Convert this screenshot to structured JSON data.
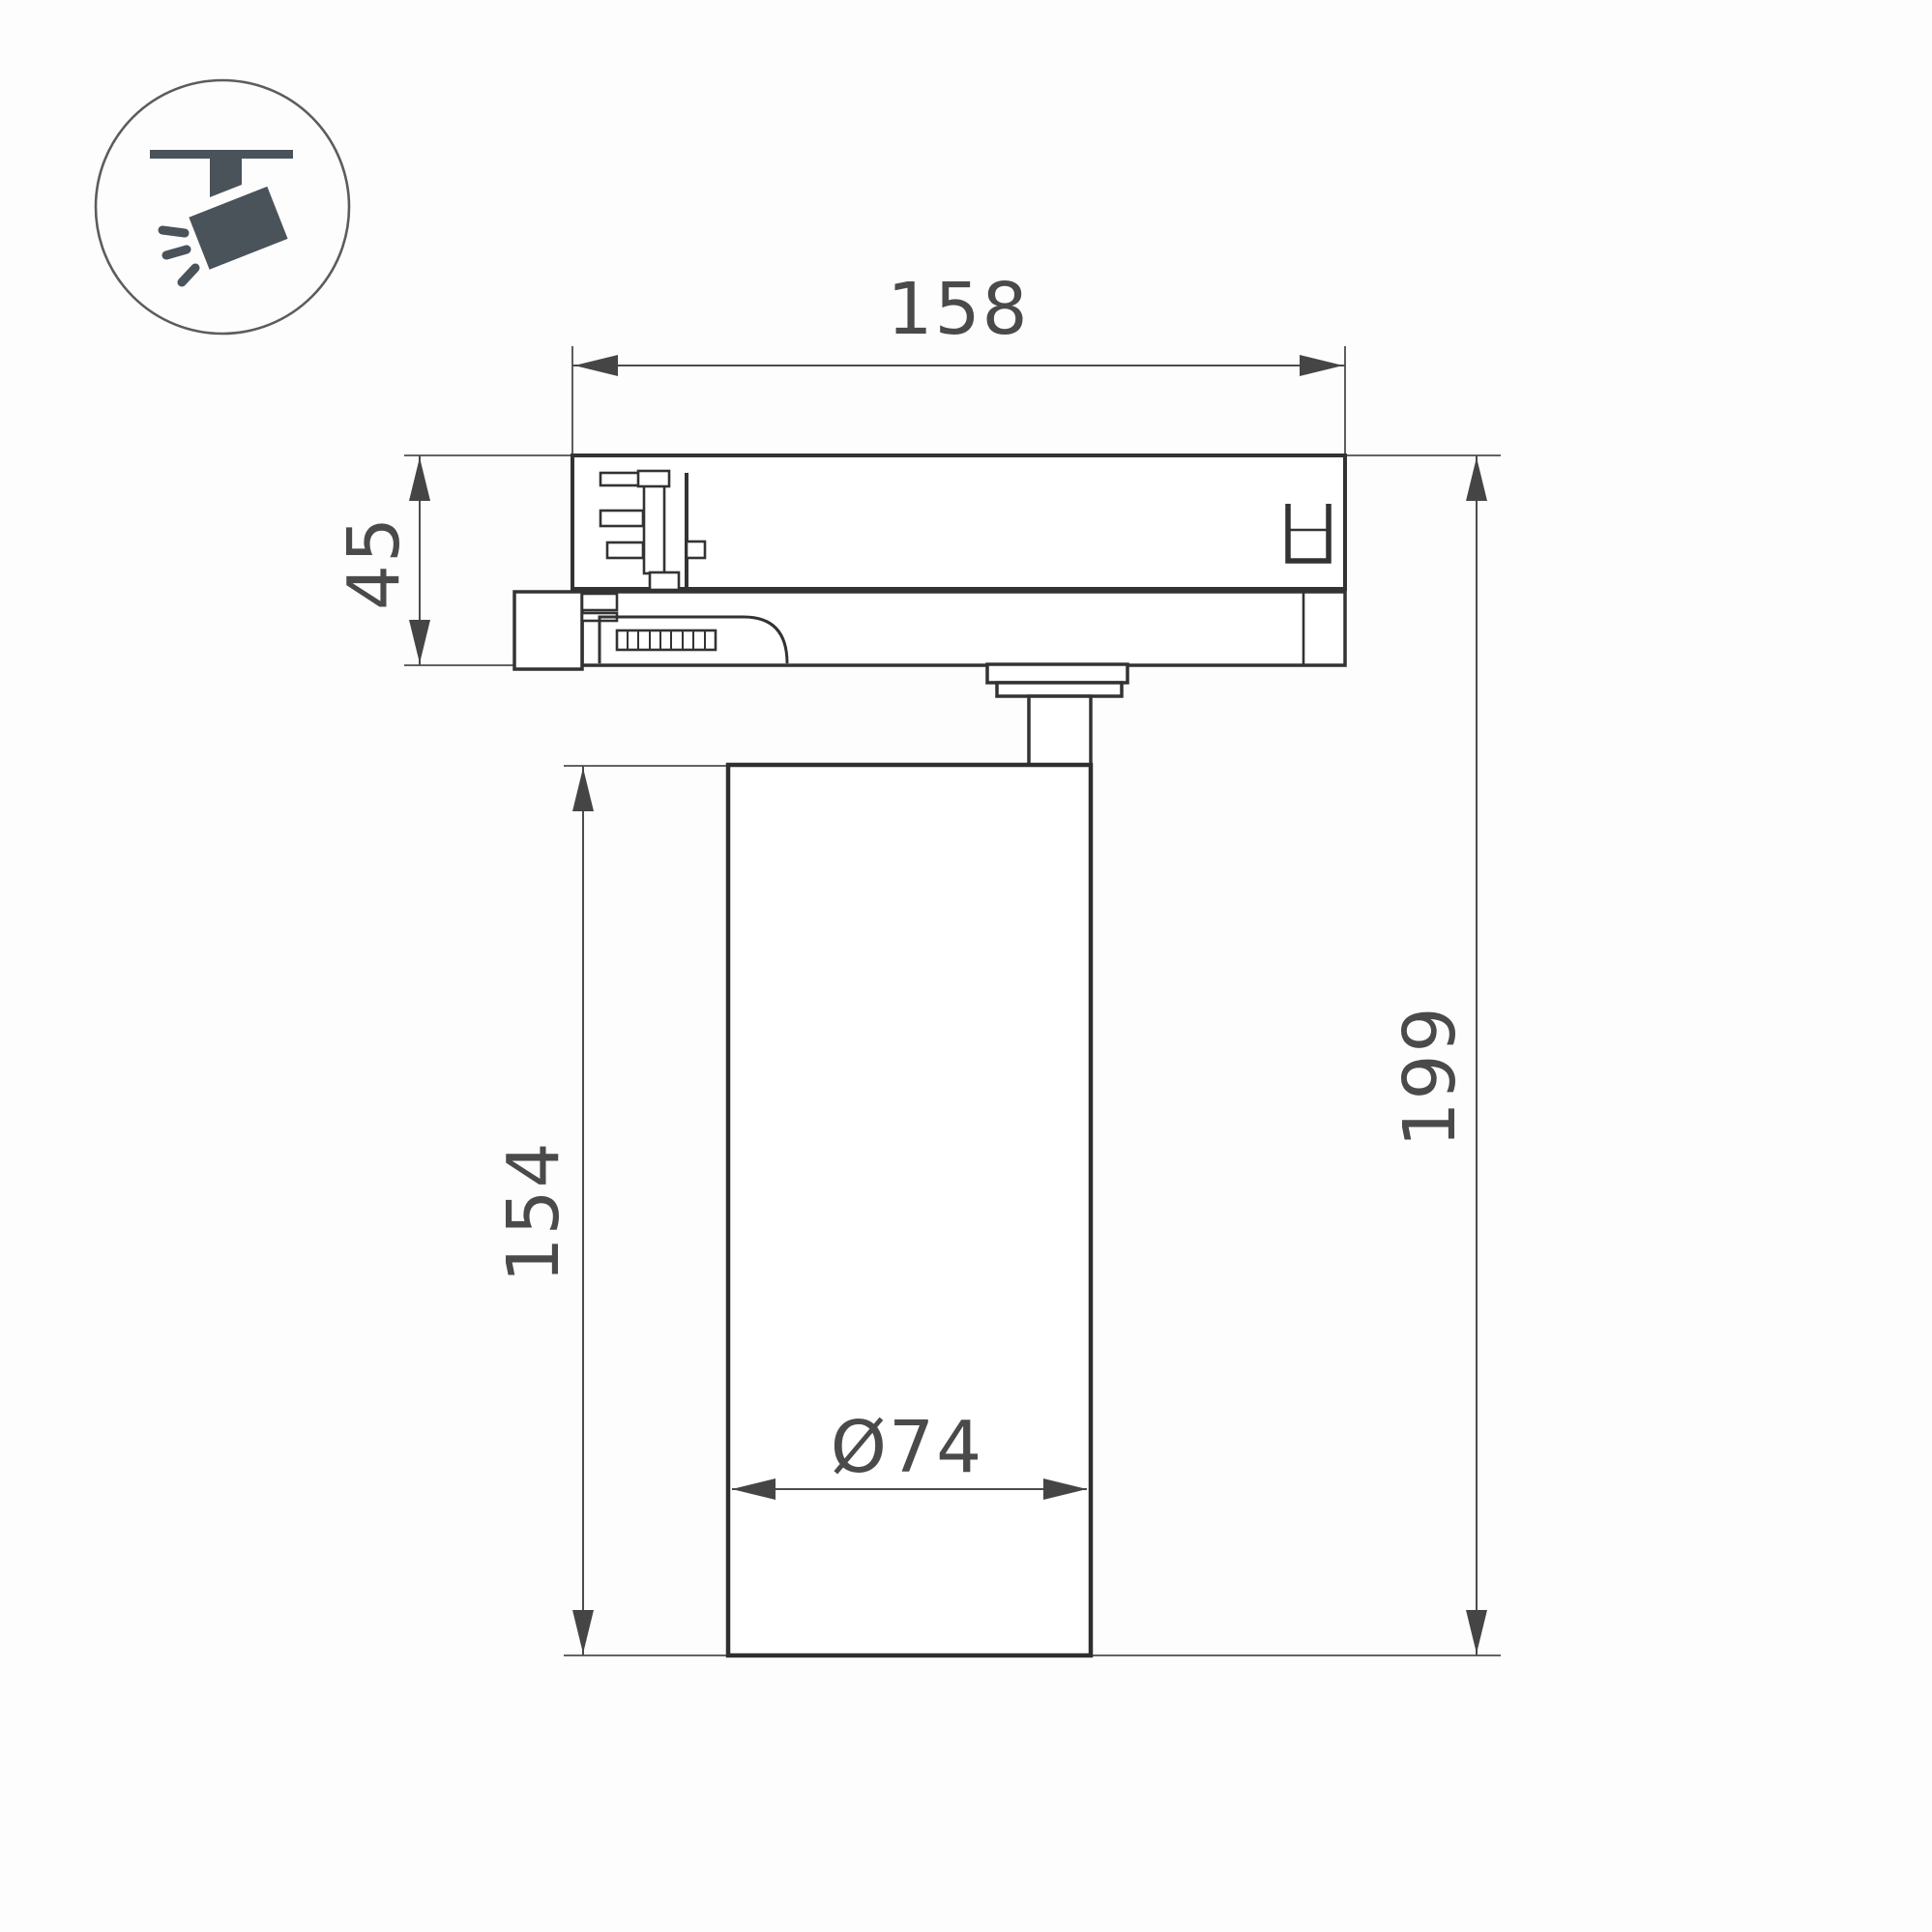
{
  "drawing": {
    "type": "technical-dimension-drawing",
    "subject": "track-mounted spotlight, side view",
    "colors": {
      "background": "#fdfdfd",
      "outline": "#333333",
      "dimension": "#4a4a4a",
      "icon": "#4a525a"
    }
  },
  "icon": {
    "name": "track-spotlight-pictogram"
  },
  "dimensions": {
    "top_width": "158",
    "adapter_height": "45",
    "body_height": "154",
    "total_height": "199",
    "body_diameter": "Ø74"
  }
}
